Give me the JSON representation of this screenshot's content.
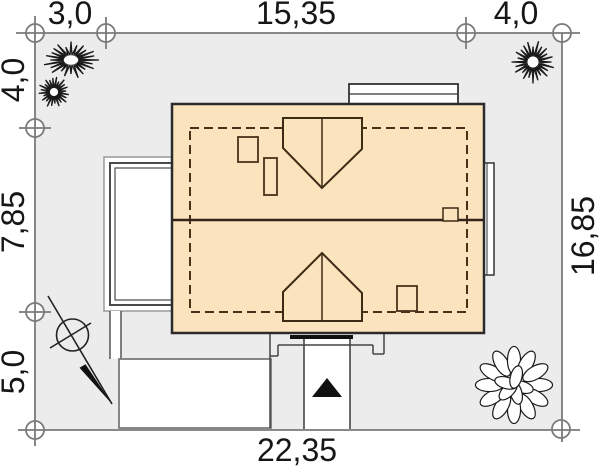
{
  "title": "house-site-plan",
  "dimensions": {
    "top": {
      "left": "3,0",
      "middle": "15,35",
      "right": "4,0"
    },
    "left": {
      "top": "4,0",
      "middle": "7,85",
      "bottom": "5,0"
    },
    "right": {
      "total": "16,85"
    },
    "bottom": {
      "total": "22,35"
    }
  },
  "colors": {
    "plot_fill": "#ececec",
    "boundary_gray": "#7a7a7a",
    "roof_fill": "#fae3bd",
    "roof_outline": "#2b2b2b",
    "roof_detail_brown": "#4a3018",
    "ink": "#161616",
    "white": "#ffffff"
  },
  "icons": [
    "north-arrow-icon",
    "entrance-arrow-icon",
    "conifer-tree-icon",
    "deciduous-tree-icon",
    "survey-marker-icon"
  ]
}
